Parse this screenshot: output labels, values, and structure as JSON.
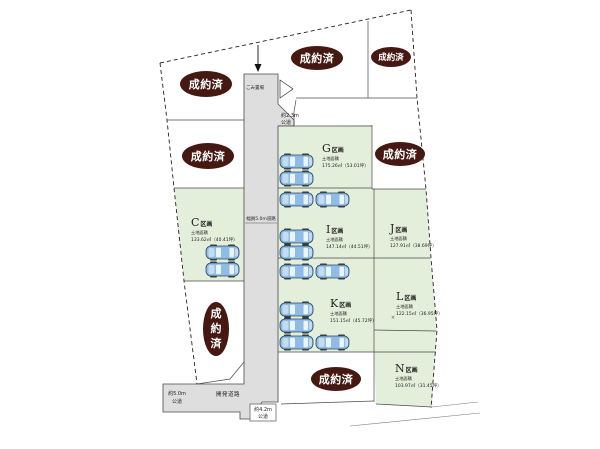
{
  "labels": {
    "sold": "成約済",
    "sold_chars": [
      "成",
      "約",
      "済"
    ]
  },
  "lots": {
    "C": {
      "letter": "C",
      "suffix": "区画",
      "area_label": "土地面積",
      "area": "133.62㎡（40.41坪）"
    },
    "G": {
      "letter": "G",
      "suffix": "区画",
      "area_label": "土地面積",
      "area": "175.26㎡（53.01坪）"
    },
    "I": {
      "letter": "I",
      "suffix": "区画",
      "area_label": "土地面積",
      "area": "147.14㎡（44.51坪）"
    },
    "J": {
      "letter": "J",
      "suffix": "区画",
      "area_label": "土地面積",
      "area": "127.91㎡（38.69坪）"
    },
    "K": {
      "letter": "K",
      "suffix": "区画",
      "area_label": "土地面積",
      "area": "151.15㎡（45.72坪）"
    },
    "L": {
      "letter": "L",
      "suffix": "区画",
      "area_label": "土地面積",
      "area": "122.15㎡（36.95坪）"
    },
    "N": {
      "letter": "N",
      "suffix": "区画",
      "area_label": "土地面積",
      "area": "103.97㎡（31.45坪）"
    }
  },
  "roads": {
    "development_road": "開発道路",
    "width_label": "幅員5.0m道路",
    "garbage": "ごみ置場",
    "public_road_left": {
      "l1": "約5.0m",
      "l2": "公道"
    },
    "public_road_corner": {
      "l1": "約4.2m",
      "l2": "公道"
    },
    "public_road_east": {
      "l1": "約2.3m",
      "l2": "公道"
    }
  },
  "marks": {
    "cross": "×"
  }
}
